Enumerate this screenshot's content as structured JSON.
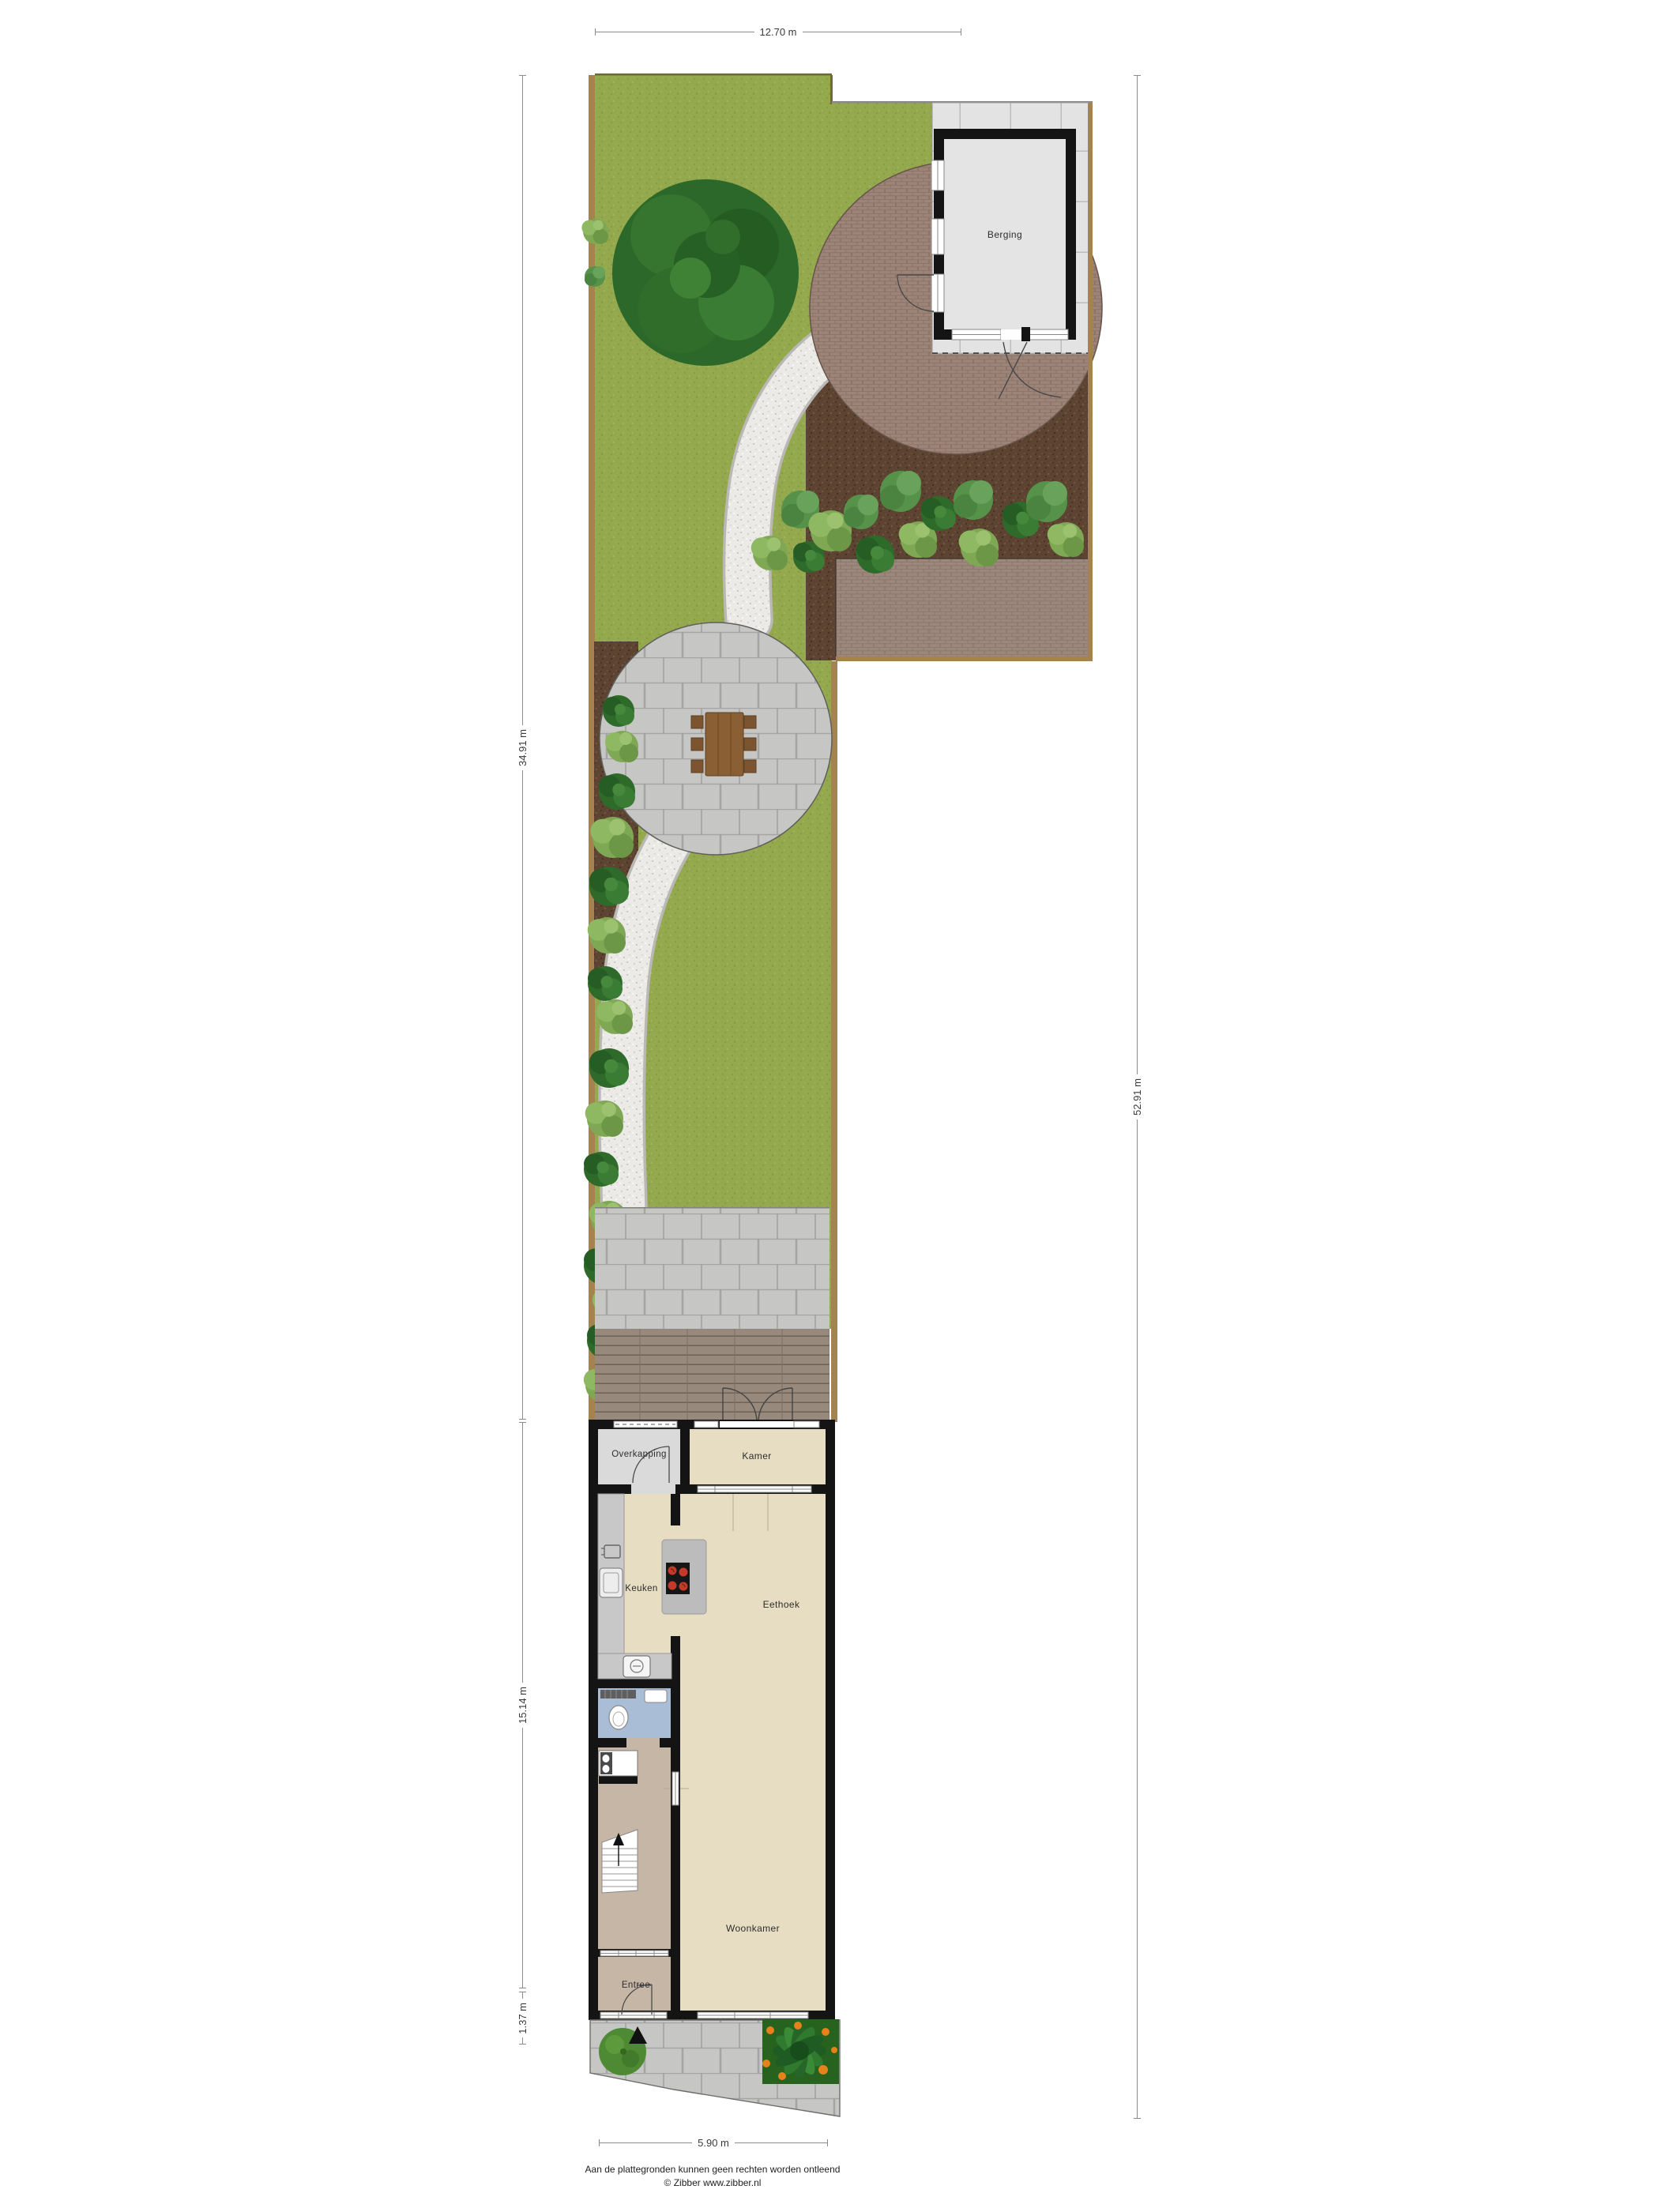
{
  "dimensions": {
    "top": "12.70 m",
    "garden_left": "34.91 m",
    "house_left": "15.14 m",
    "front_left": "1.37 m",
    "total_right": "52.91 m",
    "bottom": "5.90 m"
  },
  "rooms": {
    "berging": "Berging",
    "overkapping": "Overkapping",
    "kamer": "Kamer",
    "keuken": "Keuken",
    "eethoek": "Eethoek",
    "woonkamer": "Woonkamer",
    "entree": "Entree"
  },
  "footer": {
    "disclaimer": "Aan de plattegronden kunnen geen rechten worden ontleend",
    "credit": "© Zibber www.zibber.nl"
  },
  "colors": {
    "grass": "#94a84e",
    "mulch": "#5c4332",
    "gravel": "#eceae6",
    "brick_paving": "#9d8478",
    "block_paving": "#c6c6c4",
    "shed_tile": "#e3e3e3",
    "deck": "#97897c",
    "fence": "#a5834e",
    "wall": "#141414",
    "shed_floor": "#e4e4e4",
    "room_beige": "#e7ddc2",
    "room_gray": "#dadada",
    "toilet_blue": "#a9bdd7",
    "hall_tan": "#c6b6a6",
    "cooktop_red": "#c43a2a",
    "plant_dark": "#2e6b2b",
    "plant_light": "#7fa855"
  }
}
